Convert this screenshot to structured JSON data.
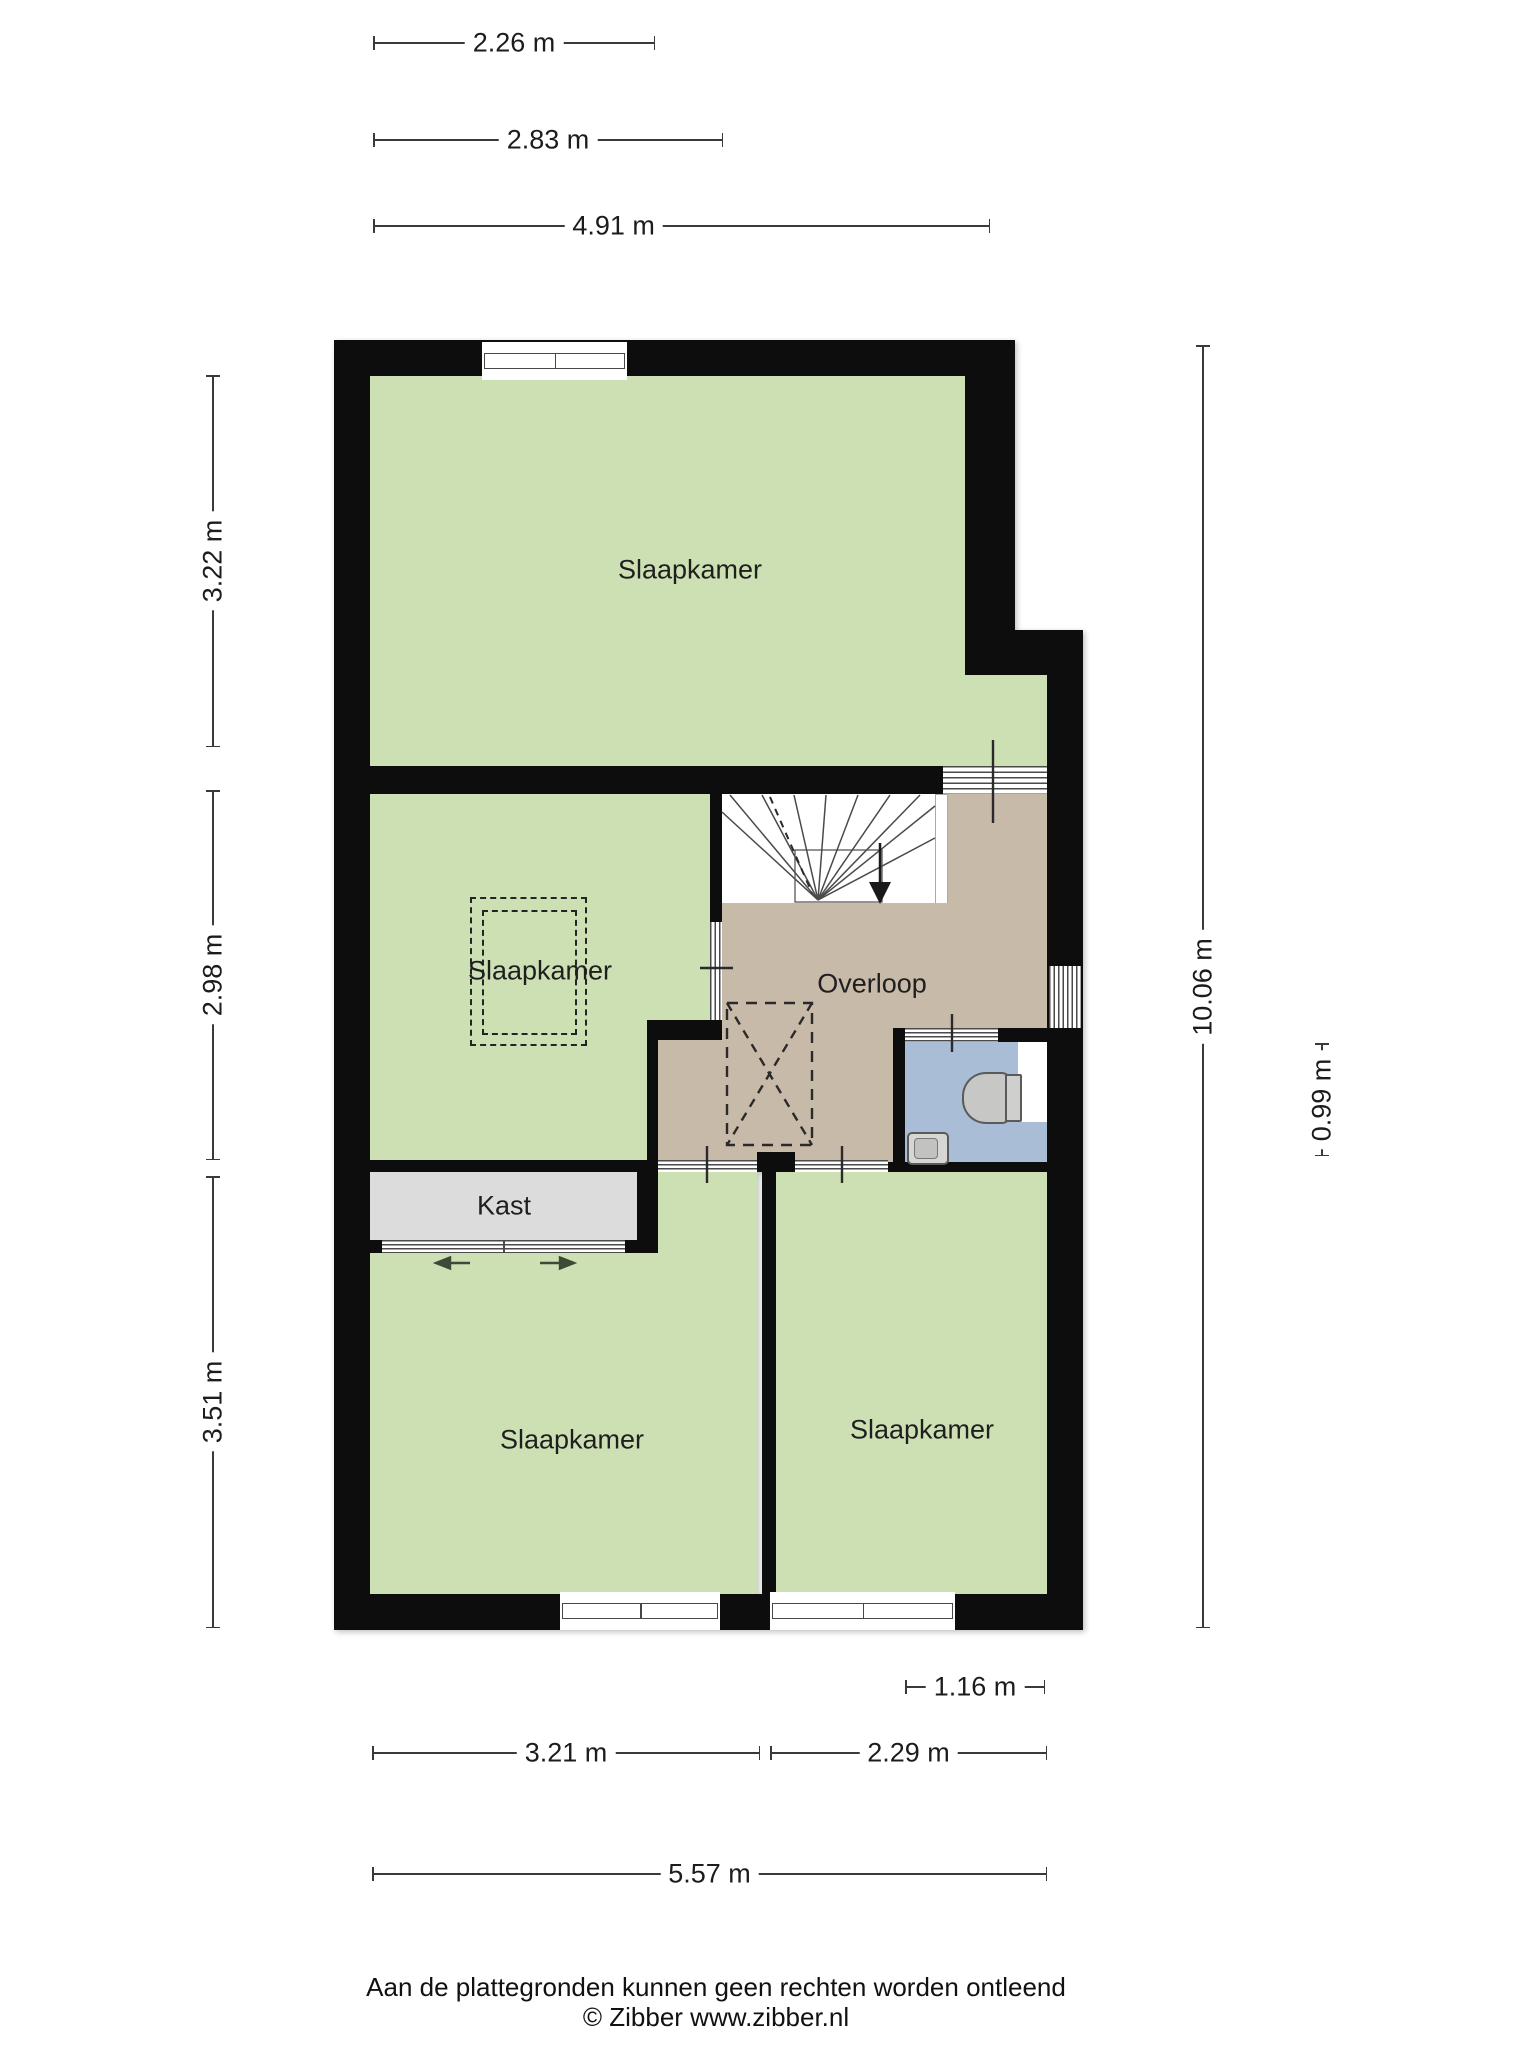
{
  "rooms": {
    "bedroom_top": {
      "label": "Slaapkamer"
    },
    "bedroom_middle": {
      "label": "Slaapkamer"
    },
    "bedroom_bottom_left": {
      "label": "Slaapkamer"
    },
    "bedroom_bottom_right": {
      "label": "Slaapkamer"
    },
    "landing": {
      "label": "Overloop"
    },
    "closet": {
      "label": "Kast"
    }
  },
  "dimensions": {
    "top": [
      {
        "label": "2.26 m"
      },
      {
        "label": "2.83 m"
      },
      {
        "label": "4.91 m"
      }
    ],
    "left": [
      {
        "label": "3.22 m"
      },
      {
        "label": "2.98 m"
      },
      {
        "label": "3.51 m"
      }
    ],
    "right": [
      {
        "label": "10.06 m"
      },
      {
        "label": "0.99 m"
      }
    ],
    "bottom": [
      {
        "label": "1.16 m"
      },
      {
        "label": "3.21 m"
      },
      {
        "label": "2.29 m"
      },
      {
        "label": "5.57 m"
      }
    ]
  },
  "footer": {
    "disclaimer": "Aan de plattegronden kunnen geen rechten worden ontleend",
    "credit": "© Zibber www.zibber.nl"
  },
  "colors": {
    "room_green": "#cde0b4",
    "landing_tan": "#c8baa9",
    "toilet_blue": "#a9bed6",
    "closet_gray": "#dcdcdc",
    "wall_black": "#0d0d0d",
    "line_dark": "#3a3a3a"
  }
}
